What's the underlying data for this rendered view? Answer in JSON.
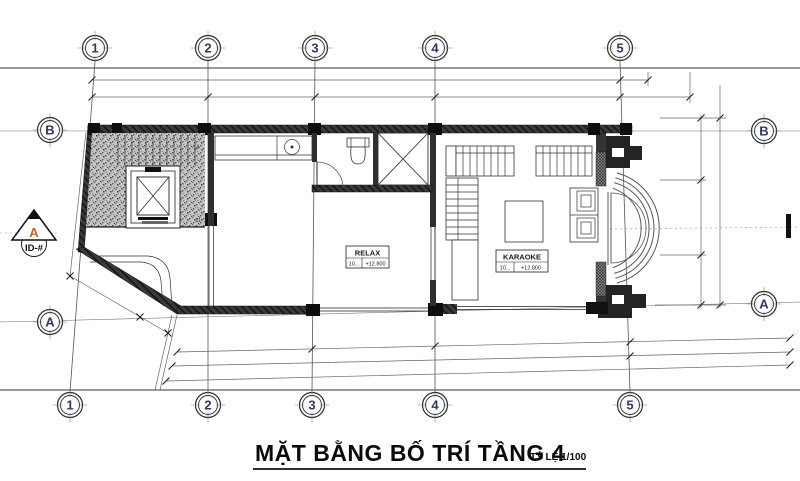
{
  "drawing": {
    "title": "MẶT BẰNG BỐ TRÍ TẦNG 4",
    "scale_label": "TỶ LỆ 1/100"
  },
  "grid": {
    "cols": [
      "1",
      "2",
      "3",
      "4",
      "5"
    ],
    "rows": {
      "top": "B",
      "bottom": "A"
    }
  },
  "section_marker": {
    "letter": "A",
    "sheet_ref": "ID-#"
  },
  "rooms": {
    "relax": {
      "name": "RELAX",
      "room_no": "10...",
      "elevation": "+12.800"
    },
    "karaoke": {
      "name": "KARAOKE",
      "room_no": "10...",
      "elevation": "+12.800"
    }
  },
  "stairs": {
    "tread_label_top": "14",
    "tread_label_bottom": "21"
  },
  "colors": {
    "line": "#1c1c1c",
    "wall": "#343434",
    "bubble_text": "#2d3a63",
    "marker_letter": "#c0662b",
    "stipple": "#c4c4c4"
  }
}
